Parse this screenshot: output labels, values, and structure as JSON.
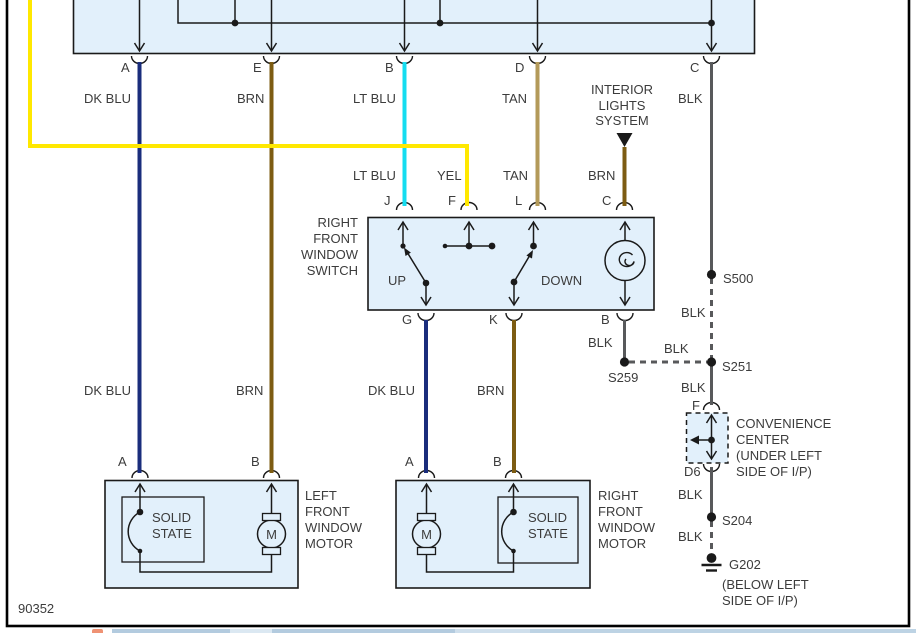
{
  "colors": {
    "box_fill": "#e2f0fb",
    "line": "#1a1a1a",
    "border": "#000000",
    "dk_blu": "#1a2d7c",
    "brn": "#7d5c12",
    "lt_blu": "#14ddf0",
    "tan": "#b39a5a",
    "yel": "#ffe800",
    "blk": "#58595b"
  },
  "figure_number": "90352",
  "pins": {
    "a": "A",
    "b": "B",
    "c": "C",
    "d": "D",
    "e": "E",
    "f": "F",
    "g": "G",
    "j": "J",
    "k": "K",
    "l": "L",
    "d6": "D6"
  },
  "wire_labels": {
    "dk_blu": "DK BLU",
    "brn": "BRN",
    "lt_blu": "LT BLU",
    "tan": "TAN",
    "yel": "YEL",
    "blk": "BLK"
  },
  "components": {
    "interior_lights": [
      "INTERIOR",
      "LIGHTS",
      "SYSTEM"
    ],
    "window_switch": [
      "RIGHT",
      "FRONT",
      "WINDOW",
      "SWITCH"
    ],
    "switch_up": "UP",
    "switch_down": "DOWN",
    "left_motor": [
      "LEFT",
      "FRONT",
      "WINDOW",
      "MOTOR"
    ],
    "right_motor": [
      "RIGHT",
      "FRONT",
      "WINDOW",
      "MOTOR"
    ],
    "solid_state": [
      "SOLID",
      "STATE"
    ],
    "motor": "M",
    "convenience_center": [
      "CONVENIENCE",
      "CENTER",
      "(UNDER LEFT",
      "SIDE OF I/P)"
    ]
  },
  "splices": {
    "s500": "S500",
    "s251": "S251",
    "s259": "S259",
    "s204": "S204"
  },
  "ground": {
    "id": "G202",
    "location": [
      "(BELOW LEFT",
      "SIDE OF I/P)"
    ]
  }
}
